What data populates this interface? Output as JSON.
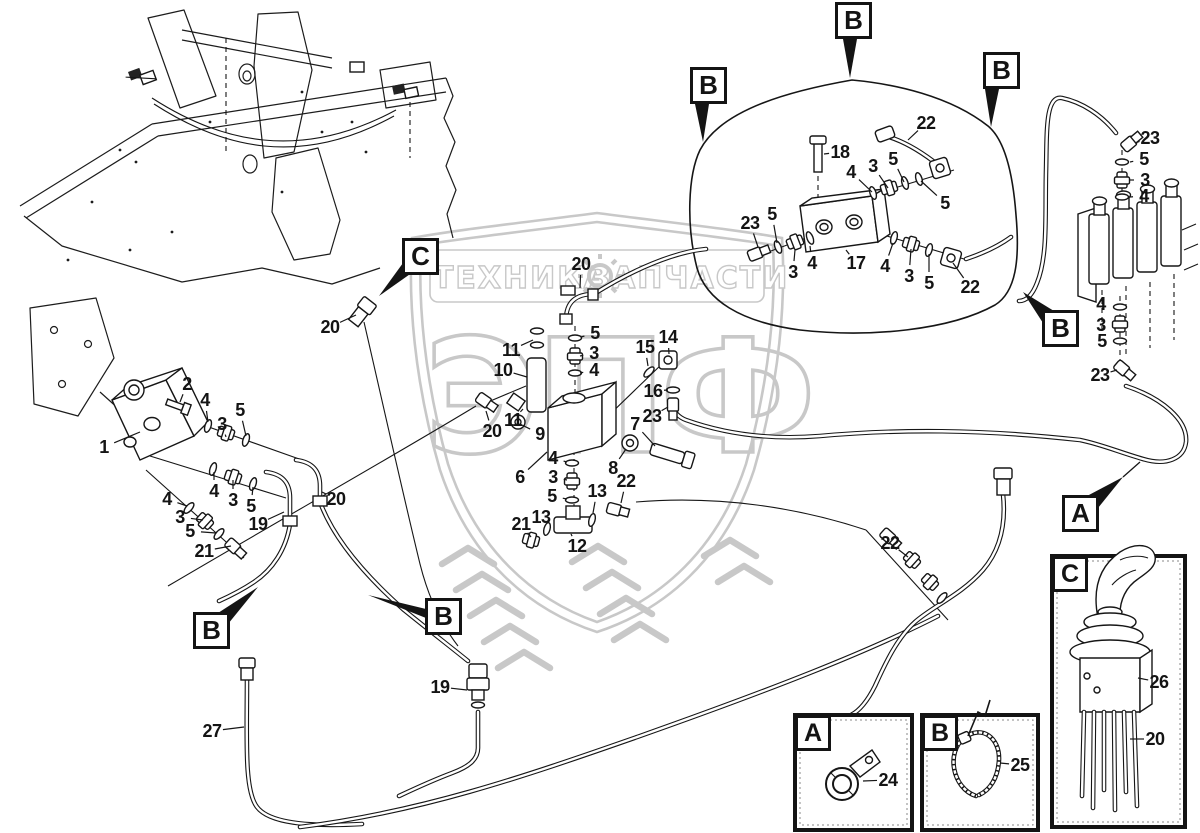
{
  "watermark": {
    "left": "ТЕХНИКА",
    "right": "ЗАПЧАСТИ",
    "letters": [
      "Э",
      "П",
      "Ф"
    ],
    "color": "#c8c8c8",
    "gear_icon": "gear-icon"
  },
  "insets": {
    "a": {
      "letter": "A",
      "part": "24",
      "icon": "clamp-icon"
    },
    "b": {
      "letter": "B",
      "part": "25",
      "icon": "cable-tie-icon"
    },
    "c": {
      "letter": "C",
      "parts": [
        "26",
        "20"
      ],
      "icon": "joystick-icon"
    }
  },
  "markers": [
    {
      "letter": "B",
      "x": 835,
      "y": 2,
      "tri": "843,39 857,39 850,78"
    },
    {
      "letter": "B",
      "x": 690,
      "y": 67,
      "tri": "695,104 709,104 703,142"
    },
    {
      "letter": "B",
      "x": 983,
      "y": 52,
      "tri": "985,89 999,89 991,127"
    },
    {
      "letter": "C",
      "x": 402,
      "y": 238,
      "tri": "403,263 413,272 379,296"
    },
    {
      "letter": "B",
      "x": 1042,
      "y": 310,
      "tri": "1043,323 1054,311 1023,292"
    },
    {
      "letter": "A",
      "x": 1062,
      "y": 495,
      "tri": "1087,496 1098,508 1123,477",
      "leader": [
        1123,
        477,
        1140,
        462
      ]
    },
    {
      "letter": "B",
      "x": 193,
      "y": 612,
      "tri": "218,613 228,624 258,587"
    },
    {
      "letter": "B",
      "x": 425,
      "y": 598,
      "tri": "426,609 431,620 368,595"
    }
  ],
  "callouts": [
    {
      "n": "1",
      "lx": 104,
      "ly": 447,
      "tx": 140,
      "ty": 432
    },
    {
      "n": "2",
      "lx": 187,
      "ly": 384,
      "tx": 180,
      "ty": 402
    },
    {
      "n": "4",
      "lx": 205,
      "ly": 400,
      "tx": 208,
      "ty": 422
    },
    {
      "n": "3",
      "lx": 222,
      "ly": 424,
      "tx": 226,
      "ty": 437
    },
    {
      "n": "5",
      "lx": 240,
      "ly": 410,
      "tx": 246,
      "ty": 436
    },
    {
      "n": "4",
      "lx": 214,
      "ly": 491,
      "tx": 214,
      "ty": 472
    },
    {
      "n": "3",
      "lx": 233,
      "ly": 500,
      "tx": 233,
      "ty": 480
    },
    {
      "n": "5",
      "lx": 251,
      "ly": 506,
      "tx": 253,
      "ty": 487
    },
    {
      "n": "4",
      "lx": 167,
      "ly": 499,
      "tx": 187,
      "ty": 506
    },
    {
      "n": "3",
      "lx": 180,
      "ly": 517,
      "tx": 203,
      "ty": 520
    },
    {
      "n": "5",
      "lx": 190,
      "ly": 531,
      "tx": 216,
      "ty": 533
    },
    {
      "n": "21",
      "lx": 204,
      "ly": 551,
      "tx": 231,
      "ty": 546
    },
    {
      "n": "19",
      "lx": 258,
      "ly": 524,
      "tx": 284,
      "ty": 512
    },
    {
      "n": "20",
      "lx": 336,
      "ly": 499,
      "tx": 322,
      "ty": 492
    },
    {
      "n": "20",
      "lx": 330,
      "ly": 327,
      "tx": 356,
      "ty": 315
    },
    {
      "n": "27",
      "lx": 212,
      "ly": 731,
      "tx": 244,
      "ty": 727
    },
    {
      "n": "19",
      "lx": 440,
      "ly": 687,
      "tx": 467,
      "ty": 690
    },
    {
      "n": "20",
      "lx": 581,
      "ly": 264,
      "tx": 580,
      "ty": 288
    },
    {
      "n": "5",
      "lx": 595,
      "ly": 333,
      "tx": 581,
      "ty": 337
    },
    {
      "n": "3",
      "lx": 594,
      "ly": 353,
      "tx": 580,
      "ty": 356
    },
    {
      "n": "4",
      "lx": 594,
      "ly": 370,
      "tx": 580,
      "ty": 373
    },
    {
      "n": "11",
      "lx": 511,
      "ly": 350,
      "tx": 533,
      "ty": 340
    },
    {
      "n": "10",
      "lx": 503,
      "ly": 370,
      "tx": 527,
      "ty": 377
    },
    {
      "n": "11",
      "lx": 513,
      "ly": 420,
      "tx": 523,
      "ty": 409
    },
    {
      "n": "20",
      "lx": 492,
      "ly": 431,
      "tx": 486,
      "ty": 411
    },
    {
      "n": "9",
      "lx": 540,
      "ly": 434,
      "tx": 522,
      "ty": 425
    },
    {
      "n": "6",
      "lx": 520,
      "ly": 477,
      "tx": 547,
      "ty": 452
    },
    {
      "n": "4",
      "lx": 553,
      "ly": 458,
      "tx": 567,
      "ty": 462
    },
    {
      "n": "3",
      "lx": 553,
      "ly": 477,
      "tx": 567,
      "ty": 480
    },
    {
      "n": "5",
      "lx": 552,
      "ly": 496,
      "tx": 567,
      "ty": 499
    },
    {
      "n": "13",
      "lx": 597,
      "ly": 491,
      "tx": 593,
      "ty": 513
    },
    {
      "n": "22",
      "lx": 626,
      "ly": 481,
      "tx": 621,
      "ty": 503
    },
    {
      "n": "21",
      "lx": 521,
      "ly": 524,
      "tx": 531,
      "ty": 537
    },
    {
      "n": "13",
      "lx": 541,
      "ly": 517,
      "tx": 547,
      "ty": 528
    },
    {
      "n": "12",
      "lx": 577,
      "ly": 546,
      "tx": 571,
      "ty": 534
    },
    {
      "n": "8",
      "lx": 613,
      "ly": 468,
      "tx": 626,
      "ty": 449
    },
    {
      "n": "7",
      "lx": 635,
      "ly": 424,
      "tx": 655,
      "ty": 446
    },
    {
      "n": "15",
      "lx": 645,
      "ly": 347,
      "tx": 648,
      "ty": 366
    },
    {
      "n": "14",
      "lx": 668,
      "ly": 337,
      "tx": 669,
      "ty": 354
    },
    {
      "n": "16",
      "lx": 653,
      "ly": 391,
      "tx": 668,
      "ty": 390
    },
    {
      "n": "23",
      "lx": 652,
      "ly": 416,
      "tx": 668,
      "ty": 407
    },
    {
      "n": "18",
      "lx": 840,
      "ly": 152,
      "tx": 824,
      "ty": 154
    },
    {
      "n": "22",
      "lx": 926,
      "ly": 123,
      "tx": 908,
      "ty": 140
    },
    {
      "n": "5",
      "lx": 893,
      "ly": 159,
      "tx": 904,
      "ty": 182
    },
    {
      "n": "3",
      "lx": 873,
      "ly": 166,
      "tx": 888,
      "ty": 188
    },
    {
      "n": "4",
      "lx": 851,
      "ly": 172,
      "tx": 872,
      "ty": 192
    },
    {
      "n": "5",
      "lx": 945,
      "ly": 203,
      "tx": 921,
      "ty": 181
    },
    {
      "n": "23",
      "lx": 750,
      "ly": 223,
      "tx": 758,
      "ty": 247
    },
    {
      "n": "5",
      "lx": 772,
      "ly": 214,
      "tx": 777,
      "ty": 243
    },
    {
      "n": "3",
      "lx": 793,
      "ly": 272,
      "tx": 795,
      "ty": 250
    },
    {
      "n": "4",
      "lx": 812,
      "ly": 263,
      "tx": 810,
      "ty": 246
    },
    {
      "n": "17",
      "lx": 856,
      "ly": 263,
      "tx": 846,
      "ty": 250
    },
    {
      "n": "4",
      "lx": 885,
      "ly": 266,
      "tx": 893,
      "ty": 243
    },
    {
      "n": "3",
      "lx": 909,
      "ly": 276,
      "tx": 911,
      "ty": 249
    },
    {
      "n": "5",
      "lx": 929,
      "ly": 283,
      "tx": 929,
      "ty": 254
    },
    {
      "n": "22",
      "lx": 970,
      "ly": 287,
      "tx": 953,
      "ty": 263
    },
    {
      "n": "23",
      "lx": 1150,
      "ly": 138,
      "tx": 1135,
      "ty": 143
    },
    {
      "n": "5",
      "lx": 1144,
      "ly": 159,
      "tx": 1130,
      "ty": 162
    },
    {
      "n": "3",
      "lx": 1145,
      "ly": 180,
      "tx": 1130,
      "ty": 180
    },
    {
      "n": "4",
      "lx": 1144,
      "ly": 196,
      "tx": 1130,
      "ty": 197
    },
    {
      "n": "4",
      "lx": 1101,
      "ly": 304,
      "tx": 1113,
      "ty": 306
    },
    {
      "n": "3",
      "lx": 1101,
      "ly": 325,
      "tx": 1113,
      "ty": 324
    },
    {
      "n": "5",
      "lx": 1102,
      "ly": 341,
      "tx": 1113,
      "ty": 341
    },
    {
      "n": "23",
      "lx": 1100,
      "ly": 375,
      "tx": 1117,
      "ty": 370
    },
    {
      "n": "22",
      "lx": 890,
      "ly": 543,
      "tx": 908,
      "ty": 557
    },
    {
      "n": "24",
      "lx": 888,
      "ly": 780,
      "tx": 863,
      "ty": 781
    },
    {
      "n": "25",
      "lx": 1020,
      "ly": 765,
      "tx": 1000,
      "ty": 763
    },
    {
      "n": "26",
      "lx": 1159,
      "ly": 682,
      "tx": 1138,
      "ty": 678
    },
    {
      "n": "20",
      "lx": 1155,
      "ly": 739,
      "tx": 1130,
      "ty": 739
    }
  ]
}
